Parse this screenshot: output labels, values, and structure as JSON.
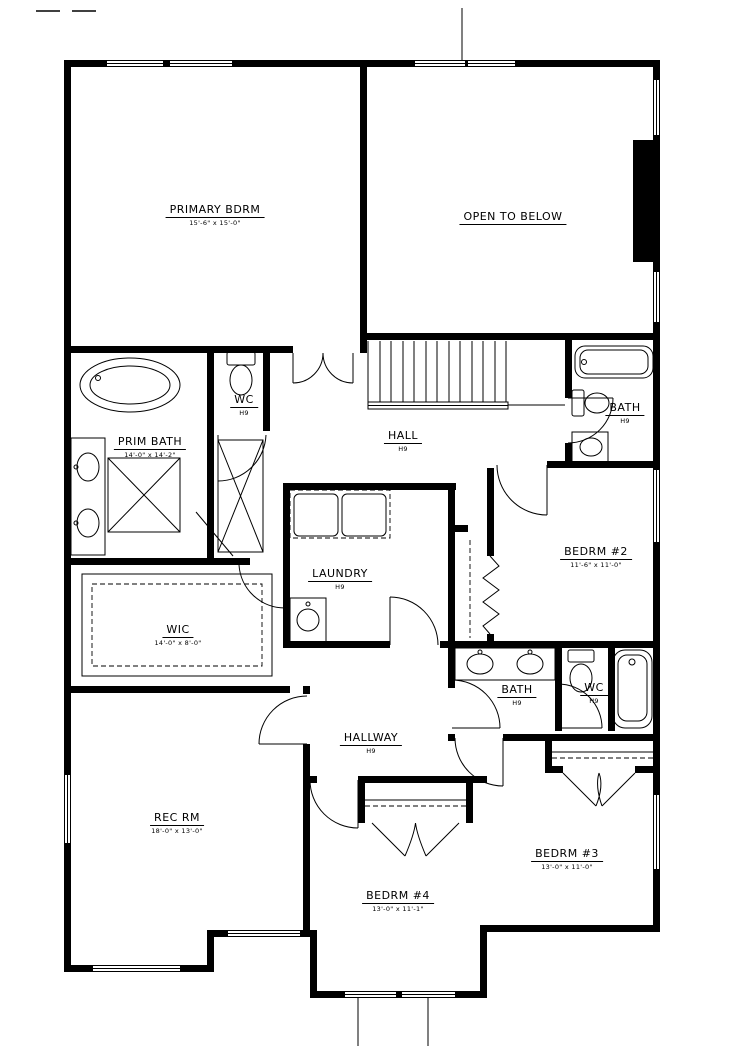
{
  "drawing": {
    "type": "residential floor plan",
    "colors": {
      "wall": "#000000",
      "background": "#ffffff"
    }
  },
  "rooms": [
    {
      "id": "primary-bdrm",
      "name": "PRIMARY BDRM",
      "sub": "15'-6\" x 15'-0\""
    },
    {
      "id": "open-to-below",
      "name": "OPEN TO BELOW",
      "sub": ""
    },
    {
      "id": "wc-primary",
      "name": "WC",
      "sub": "H9"
    },
    {
      "id": "prim-bath",
      "name": "PRIM BATH",
      "sub": "14'-0\" x 14'-2\""
    },
    {
      "id": "hall",
      "name": "HALL",
      "sub": "H9"
    },
    {
      "id": "bath-upper",
      "name": "BATH",
      "sub": "H9"
    },
    {
      "id": "bedrm-2",
      "name": "BEDRM #2",
      "sub": "11'-6\" x 11'-0\""
    },
    {
      "id": "laundry",
      "name": "LAUNDRY",
      "sub": "H9"
    },
    {
      "id": "wic",
      "name": "WIC",
      "sub": "14'-0\" x 8'-0\""
    },
    {
      "id": "bath-middle",
      "name": "BATH",
      "sub": "H9"
    },
    {
      "id": "wc-middle",
      "name": "WC",
      "sub": "H9"
    },
    {
      "id": "hallway",
      "name": "HALLWAY",
      "sub": "H9"
    },
    {
      "id": "rec-rm",
      "name": "REC RM",
      "sub": "18'-0\" x 13'-0\""
    },
    {
      "id": "bedrm-4",
      "name": "BEDRM #4",
      "sub": "13'-0\" x 11'-1\""
    },
    {
      "id": "bedrm-3",
      "name": "BEDRM #3",
      "sub": "13'-0\" x 11'-0\""
    }
  ]
}
